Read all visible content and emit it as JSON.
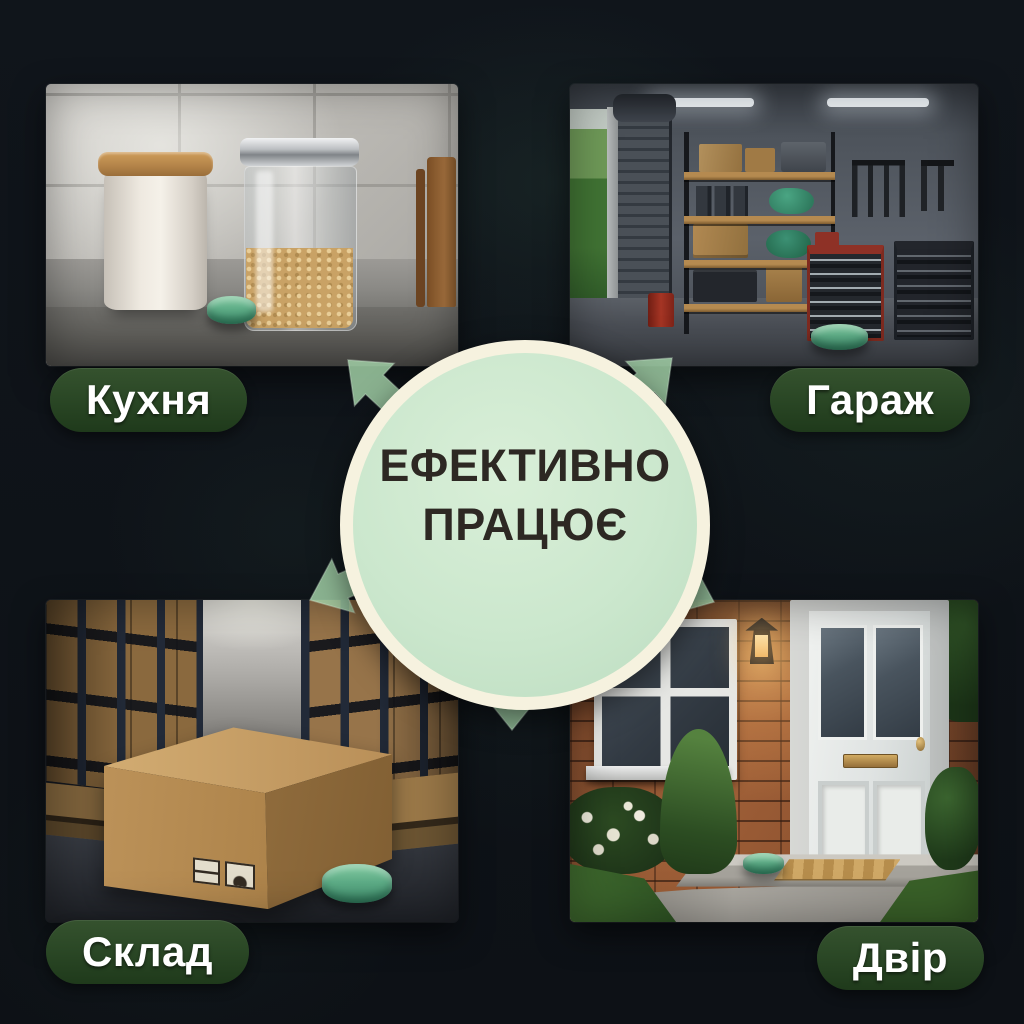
{
  "title": {
    "line1": "ЕФЕКТИВНО",
    "line2": "ПРАЦЮЄ"
  },
  "panels": [
    {
      "id": "kitchen",
      "label": "Кухня",
      "position": "top-left",
      "scene": "kitchen counter with white canister, glass jar of grain and green repellent tablet"
    },
    {
      "id": "garage",
      "label": "Гараж",
      "position": "top-right",
      "scene": "garage with shelving, tool cabinets, roller door and green repellent tablet on floor"
    },
    {
      "id": "warehouse",
      "label": "Склад",
      "position": "bottom-left",
      "scene": "warehouse aisle with racks of boxes, large cardboard box and green repellent tablet"
    },
    {
      "id": "yard",
      "label": "Двір",
      "position": "bottom-right",
      "scene": "house entrance with brick wall, white door, lantern and green repellent tablet on step"
    }
  ],
  "colors": {
    "background": "#0e1217",
    "circle_fill": "#cde8cf",
    "circle_ring": "#f6f2df",
    "title_text": "#2d2823",
    "badge_green": "#2b4826",
    "badge_text": "#ffffff",
    "arrow_green": "#a6d6ab",
    "tablet_green": "#5cb493"
  }
}
